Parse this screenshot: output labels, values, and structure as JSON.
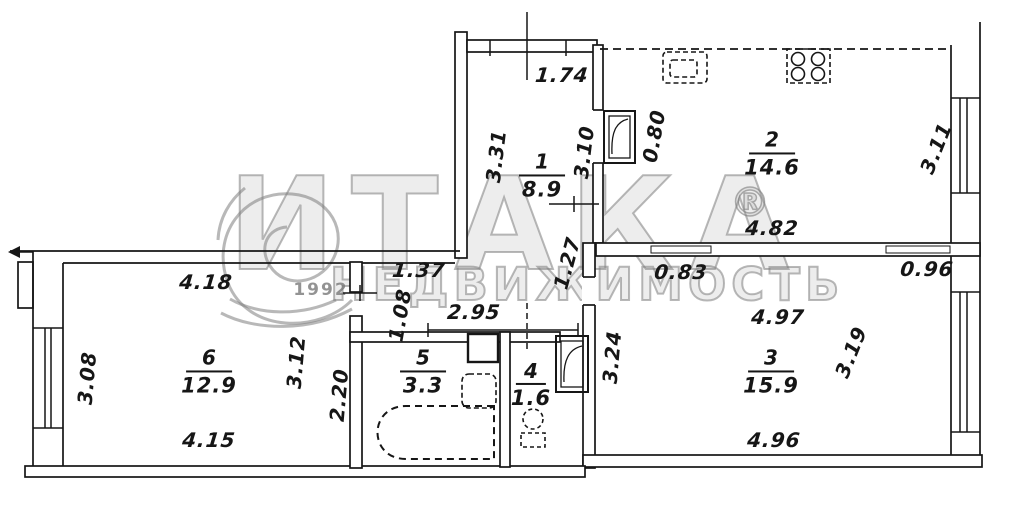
{
  "watermark": {
    "brand": "ИТАКА",
    "registered_mark": "®",
    "subtitle": "НЕДВИЖИМОСТЬ",
    "year": "1992",
    "color": "#7d7d7d"
  },
  "plan": {
    "line_color": "#161616",
    "paper_color": "#ffffff"
  },
  "rooms": {
    "r1": {
      "number": "1",
      "area": "8.9"
    },
    "r2": {
      "number": "2",
      "area": "14.6"
    },
    "r3": {
      "number": "3",
      "area": "15.9"
    },
    "r4": {
      "number": "4",
      "area": "1.6"
    },
    "r5": {
      "number": "5",
      "area": "3.3"
    },
    "r6": {
      "number": "6",
      "area": "12.9"
    }
  },
  "dimensions": {
    "top_hall_width": "1.74",
    "hall_left": "3.31",
    "hall_right": "3.10",
    "kitchen_door": "0.80",
    "kitchen_width": "4.82",
    "kitchen_window": "3.11",
    "corridor_notch": "1.27",
    "room3_door_left": "0.83",
    "room3_door_right": "0.96",
    "room3_top": "4.97",
    "room3_window": "3.19",
    "room3_left": "3.24",
    "room3_bottom": "4.96",
    "room6_top": "4.18",
    "corridor_width_a": "1.37",
    "corridor_height": "1.08",
    "corridor_width_b": "2.95",
    "room6_window": "3.08",
    "room6_right": "3.12",
    "room6_right2": "2.20",
    "room6_bottom": "4.15"
  }
}
